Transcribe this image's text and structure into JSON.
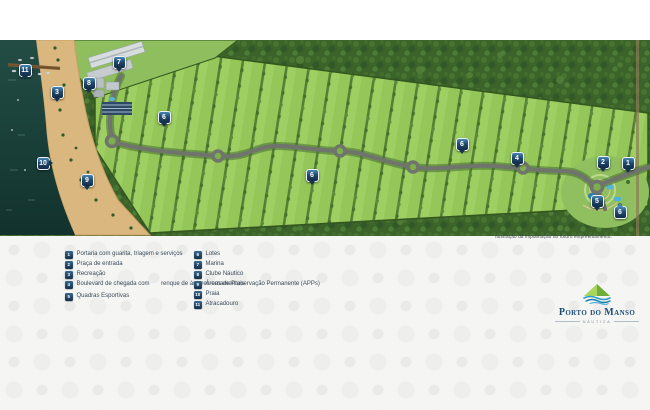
{
  "brand": {
    "name": "Porto do Manso",
    "tagline": "Náutica",
    "navy": "#1d4e79",
    "marker_navy": "#16334f"
  },
  "map": {
    "disclaimer": "Ilustração da implantação do futuro empreendimento.",
    "colors": {
      "forest_green": "#3c6329",
      "lot_green": "#9ecf63",
      "water_teal": "#1c4038",
      "sand": "#d9b77e",
      "road_gray": "#6f746c"
    },
    "markers": [
      {
        "num": "11",
        "x": 25,
        "y": 70
      },
      {
        "num": "7",
        "x": 119,
        "y": 62
      },
      {
        "num": "8",
        "x": 89,
        "y": 83
      },
      {
        "num": "3",
        "x": 57,
        "y": 92
      },
      {
        "num": "10",
        "x": 43,
        "y": 163,
        "pointer": "right"
      },
      {
        "num": "9",
        "x": 87,
        "y": 180
      },
      {
        "num": "6",
        "x": 164,
        "y": 117
      },
      {
        "num": "6",
        "x": 312,
        "y": 175
      },
      {
        "num": "6",
        "x": 462,
        "y": 144
      },
      {
        "num": "4",
        "x": 517,
        "y": 158
      },
      {
        "num": "2",
        "x": 603,
        "y": 162
      },
      {
        "num": "1",
        "x": 628,
        "y": 163
      },
      {
        "num": "5",
        "x": 597,
        "y": 201
      },
      {
        "num": "6",
        "x": 620,
        "y": 212,
        "pointer": "up"
      }
    ]
  },
  "legend": {
    "left": [
      {
        "num": "1",
        "label": "Portaria com guarita, triagem e serviços"
      },
      {
        "num": "2",
        "label": "Praça de entrada"
      },
      {
        "num": "3",
        "label": "Recreação"
      },
      {
        "num": "4",
        "label": "Boulevard de chegada com",
        "label2": "renque de árvores ornamentais"
      },
      {
        "num": "5",
        "label": "Quadras Esportivas"
      }
    ],
    "right": [
      {
        "num": "6",
        "label": "Lotes"
      },
      {
        "num": "7",
        "label": "Marina"
      },
      {
        "num": "8",
        "label": "Clube Náutico"
      },
      {
        "num": "9",
        "label": "Áreas de Preservação Permanente (APPs)"
      },
      {
        "num": "10",
        "label": "Praia"
      },
      {
        "num": "11",
        "label": "Atracadouro"
      }
    ]
  }
}
